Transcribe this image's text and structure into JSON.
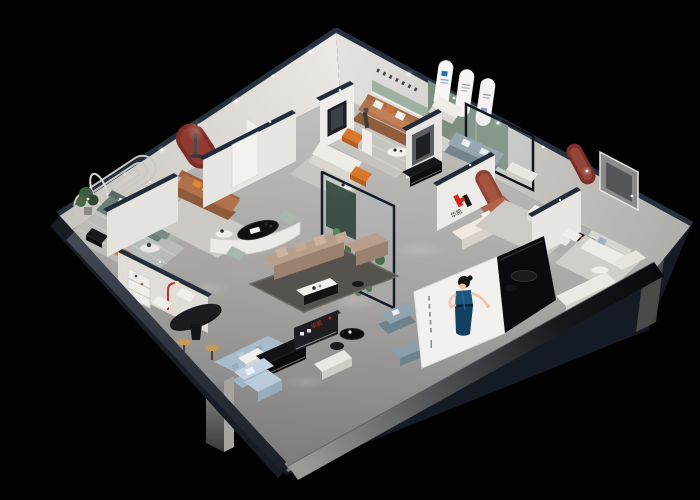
{
  "meta": {
    "title": "3D cutaway render of a furniture showroom floor plan",
    "canvas": {
      "width": 700,
      "height": 500
    },
    "background_color": "#020203"
  },
  "brand": {
    "mark": "H",
    "name": "华凯",
    "red": "#d3281e",
    "dark": "#141414"
  },
  "signs": {
    "logo_wall_name": "华凯",
    "front_display_name": "华凯"
  },
  "palette": {
    "exterior_navy": "#161c26",
    "wall_cap_navy": "#232c3a",
    "wall_white": "#e9e7e3",
    "floor_light": "#bdbcba",
    "floor_dark": "#7f7e7c",
    "accent_terracotta": "#a65847",
    "accent_dark_red_arch": "#7c2e28",
    "accent_orange": "#d8772b",
    "sofa_caramel": "#b07450",
    "sofa_taupe": "#b89e8b",
    "sofa_green_grey": "#6d7d78",
    "sofa_light_blue": "#c3d3e1",
    "sofa_slate_blue": "#91a5af",
    "sage_green_wall": "#7e8f81",
    "poster_dress_blue": "#1c567e",
    "poster_panel": "#f2f1ef",
    "plant_green": "#4f7d4f"
  }
}
